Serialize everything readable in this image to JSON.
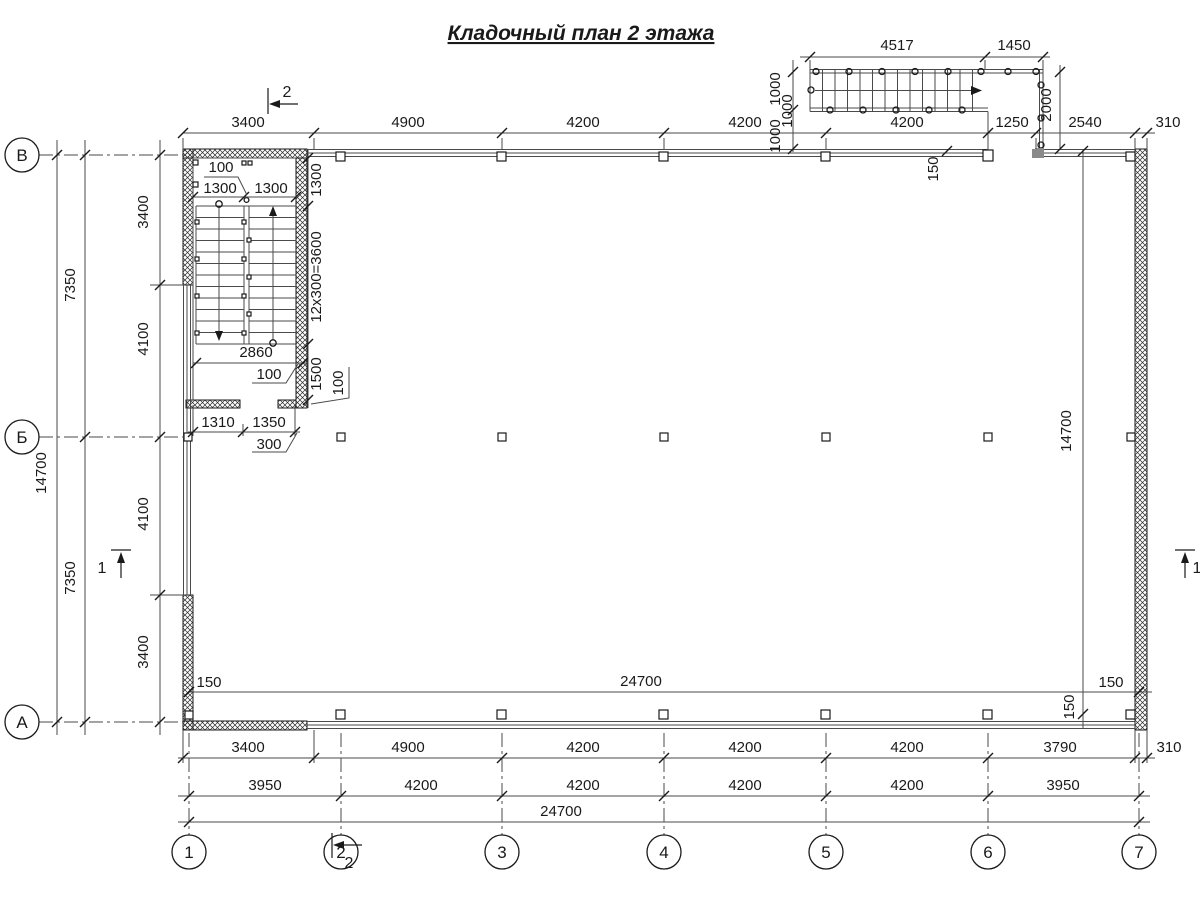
{
  "title": "Кладочный план 2 этажа",
  "axes": {
    "rows": [
      "В",
      "Б",
      "А"
    ],
    "cols": [
      "1",
      "2",
      "3",
      "4",
      "5",
      "6",
      "7"
    ]
  },
  "markers": {
    "section1": "1",
    "section2": "2"
  },
  "dims": {
    "top": [
      "3400",
      "4900",
      "4200",
      "4200",
      "4200",
      "1250",
      "2540",
      "310"
    ],
    "bottom1": [
      "3400",
      "4900",
      "4200",
      "4200",
      "4200",
      "3790",
      "310"
    ],
    "bottom2": [
      "3950",
      "4200",
      "4200",
      "4200",
      "4200",
      "3950"
    ],
    "bottom3": "24700",
    "left_outer": "14700",
    "left_mid": [
      "7350",
      "7350"
    ],
    "left_inner": [
      "3400",
      "4100",
      "4100",
      "3400"
    ],
    "int_width": "24700",
    "int_height": "14700",
    "off150": [
      "150",
      "150",
      "150",
      "150"
    ],
    "ext_top": [
      "4517",
      "1450"
    ],
    "ext_left": [
      "1000",
      "1000",
      "1000"
    ],
    "ext_depth": "2000",
    "stw_gap": "100",
    "stw_fl1": "1300",
    "stw_fl2": "1300",
    "stw_land": "1300",
    "stw_run": "12x300=3600",
    "stw_width": "2860",
    "stw_off1": "100",
    "stw_low": "1500",
    "stw_off2": "100",
    "stw_door1": "1310",
    "stw_door2": "1350",
    "stw_pier": "300"
  }
}
